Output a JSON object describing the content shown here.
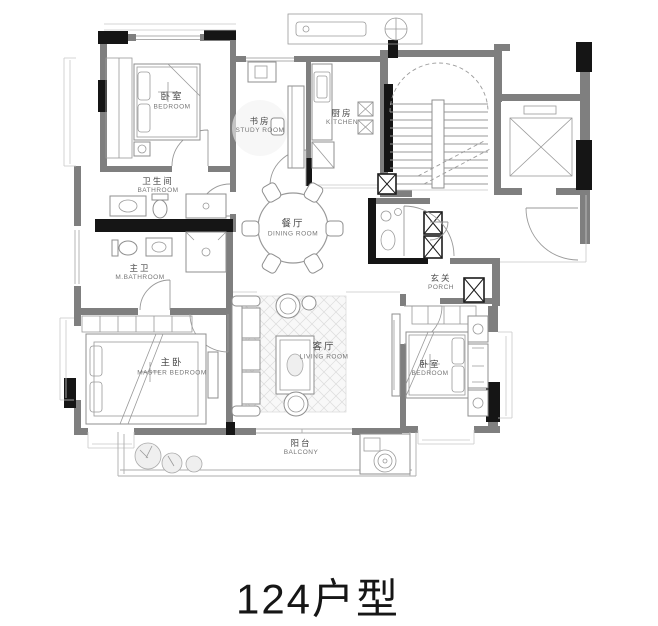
{
  "title": "124户型",
  "rooms": [
    {
      "id": "bedroom-top",
      "cn": "卧室",
      "en": "BEDROOM"
    },
    {
      "id": "study-room",
      "cn": "书房",
      "en": "STUDY ROOM"
    },
    {
      "id": "kitchen",
      "cn": "厨房",
      "en": "KITCHEN"
    },
    {
      "id": "bathroom",
      "cn": "卫生间",
      "en": "BATHROOM"
    },
    {
      "id": "dining-room",
      "cn": "餐厅",
      "en": "DINING ROOM"
    },
    {
      "id": "master-bathroom",
      "cn": "主卫",
      "en": "M.BATHROOM"
    },
    {
      "id": "master-bedroom",
      "cn": "主卧",
      "en": "MASTER BEDROOM"
    },
    {
      "id": "living-room",
      "cn": "客厅",
      "en": "LIVING ROOM"
    },
    {
      "id": "porch",
      "cn": "玄关",
      "en": "PORCH"
    },
    {
      "id": "bedroom-right",
      "cn": "卧室",
      "en": "BEDROOM"
    },
    {
      "id": "balcony",
      "cn": "阳台",
      "en": "BALCONY"
    }
  ],
  "colors": {
    "background": "#ffffff",
    "wall": "#7f7f7f",
    "column": "#151515",
    "line": "#9a9a9a",
    "title": "#161616",
    "label_cn": "#4a4a4a",
    "label_en": "#767676"
  }
}
